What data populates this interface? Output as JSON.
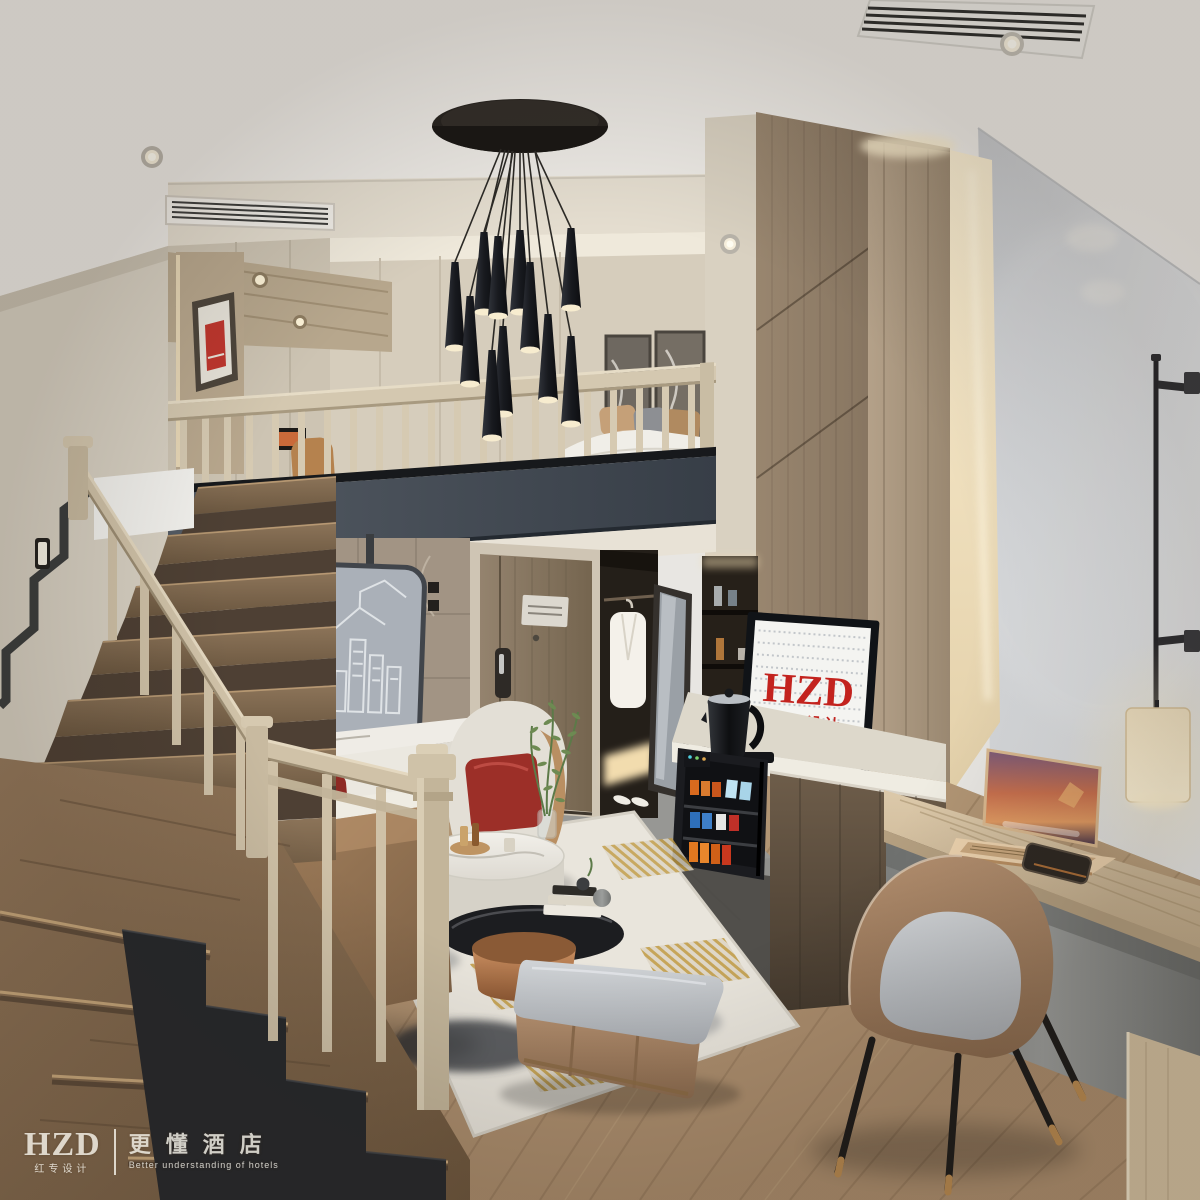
{
  "meta": {
    "description": "3D interior render of a duplex loft hotel guest room with staircase, mezzanine bedroom, living area, TV wall and work desk",
    "render_style": "photorealistic"
  },
  "tv_screen": {
    "logo": "HZD",
    "logo_cn": "红专设计",
    "logo_color": "#c3231e",
    "screen_bg": "#f4f4f1",
    "map_color": "#c2c6ca"
  },
  "watermark": {
    "logo": "HZD",
    "logo_cn": "红专设计",
    "cn": "更懂酒店",
    "en": "Better understanding of hotels",
    "color": "#f6f3ea"
  },
  "palette": {
    "ceiling": "#edeae5",
    "right_wall": "#d4d6d8",
    "beige_wall": "#d6cdbc",
    "wood_light": "#d2c6ae",
    "wood_wall": "#8f7d68",
    "fascia_slab": "#49505a",
    "stair_tread": "#7c6550",
    "leather_tan": "#a5815f",
    "seat_gray": "#c3c7cb",
    "accent_red": "#8e2a24",
    "copper": "#b97a4e",
    "warm_glow": "#f6e7c6",
    "floor_wood": "#ab8d6d",
    "entry_tile": "#90908d"
  },
  "objects": [
    "pendant-cluster-chandelier",
    "round-ceiling-canopy",
    "staircase",
    "stair-railing",
    "mezzanine-railing",
    "mezzanine-bedroom",
    "bed",
    "wall-artwork",
    "red-framed-art",
    "bathroom-stone-wall",
    "city-relief-panel",
    "marble-half-wall",
    "toilet",
    "entry-door",
    "door-lock",
    "wardrobe",
    "bathrobe",
    "floor-mirror",
    "slippers",
    "tv-wood-wall",
    "led-cove",
    "shelf-niche",
    "tv",
    "electric-kettle",
    "minibar-fridge",
    "media-console",
    "work-desk",
    "laptop",
    "smartphone",
    "desk-chair",
    "cylinder-pendant-lamp",
    "wall-rod-light",
    "sofa",
    "throw-pillows",
    "armchair",
    "decor-plant",
    "marble-coffee-table",
    "black-glass-coffee-table",
    "book-stack",
    "storage-ottoman",
    "area-rug",
    "wood-plank-floor",
    "entry-tile-floor",
    "ceiling-air-vents",
    "recessed-downlights",
    "stair-step-lights",
    "watermark"
  ]
}
